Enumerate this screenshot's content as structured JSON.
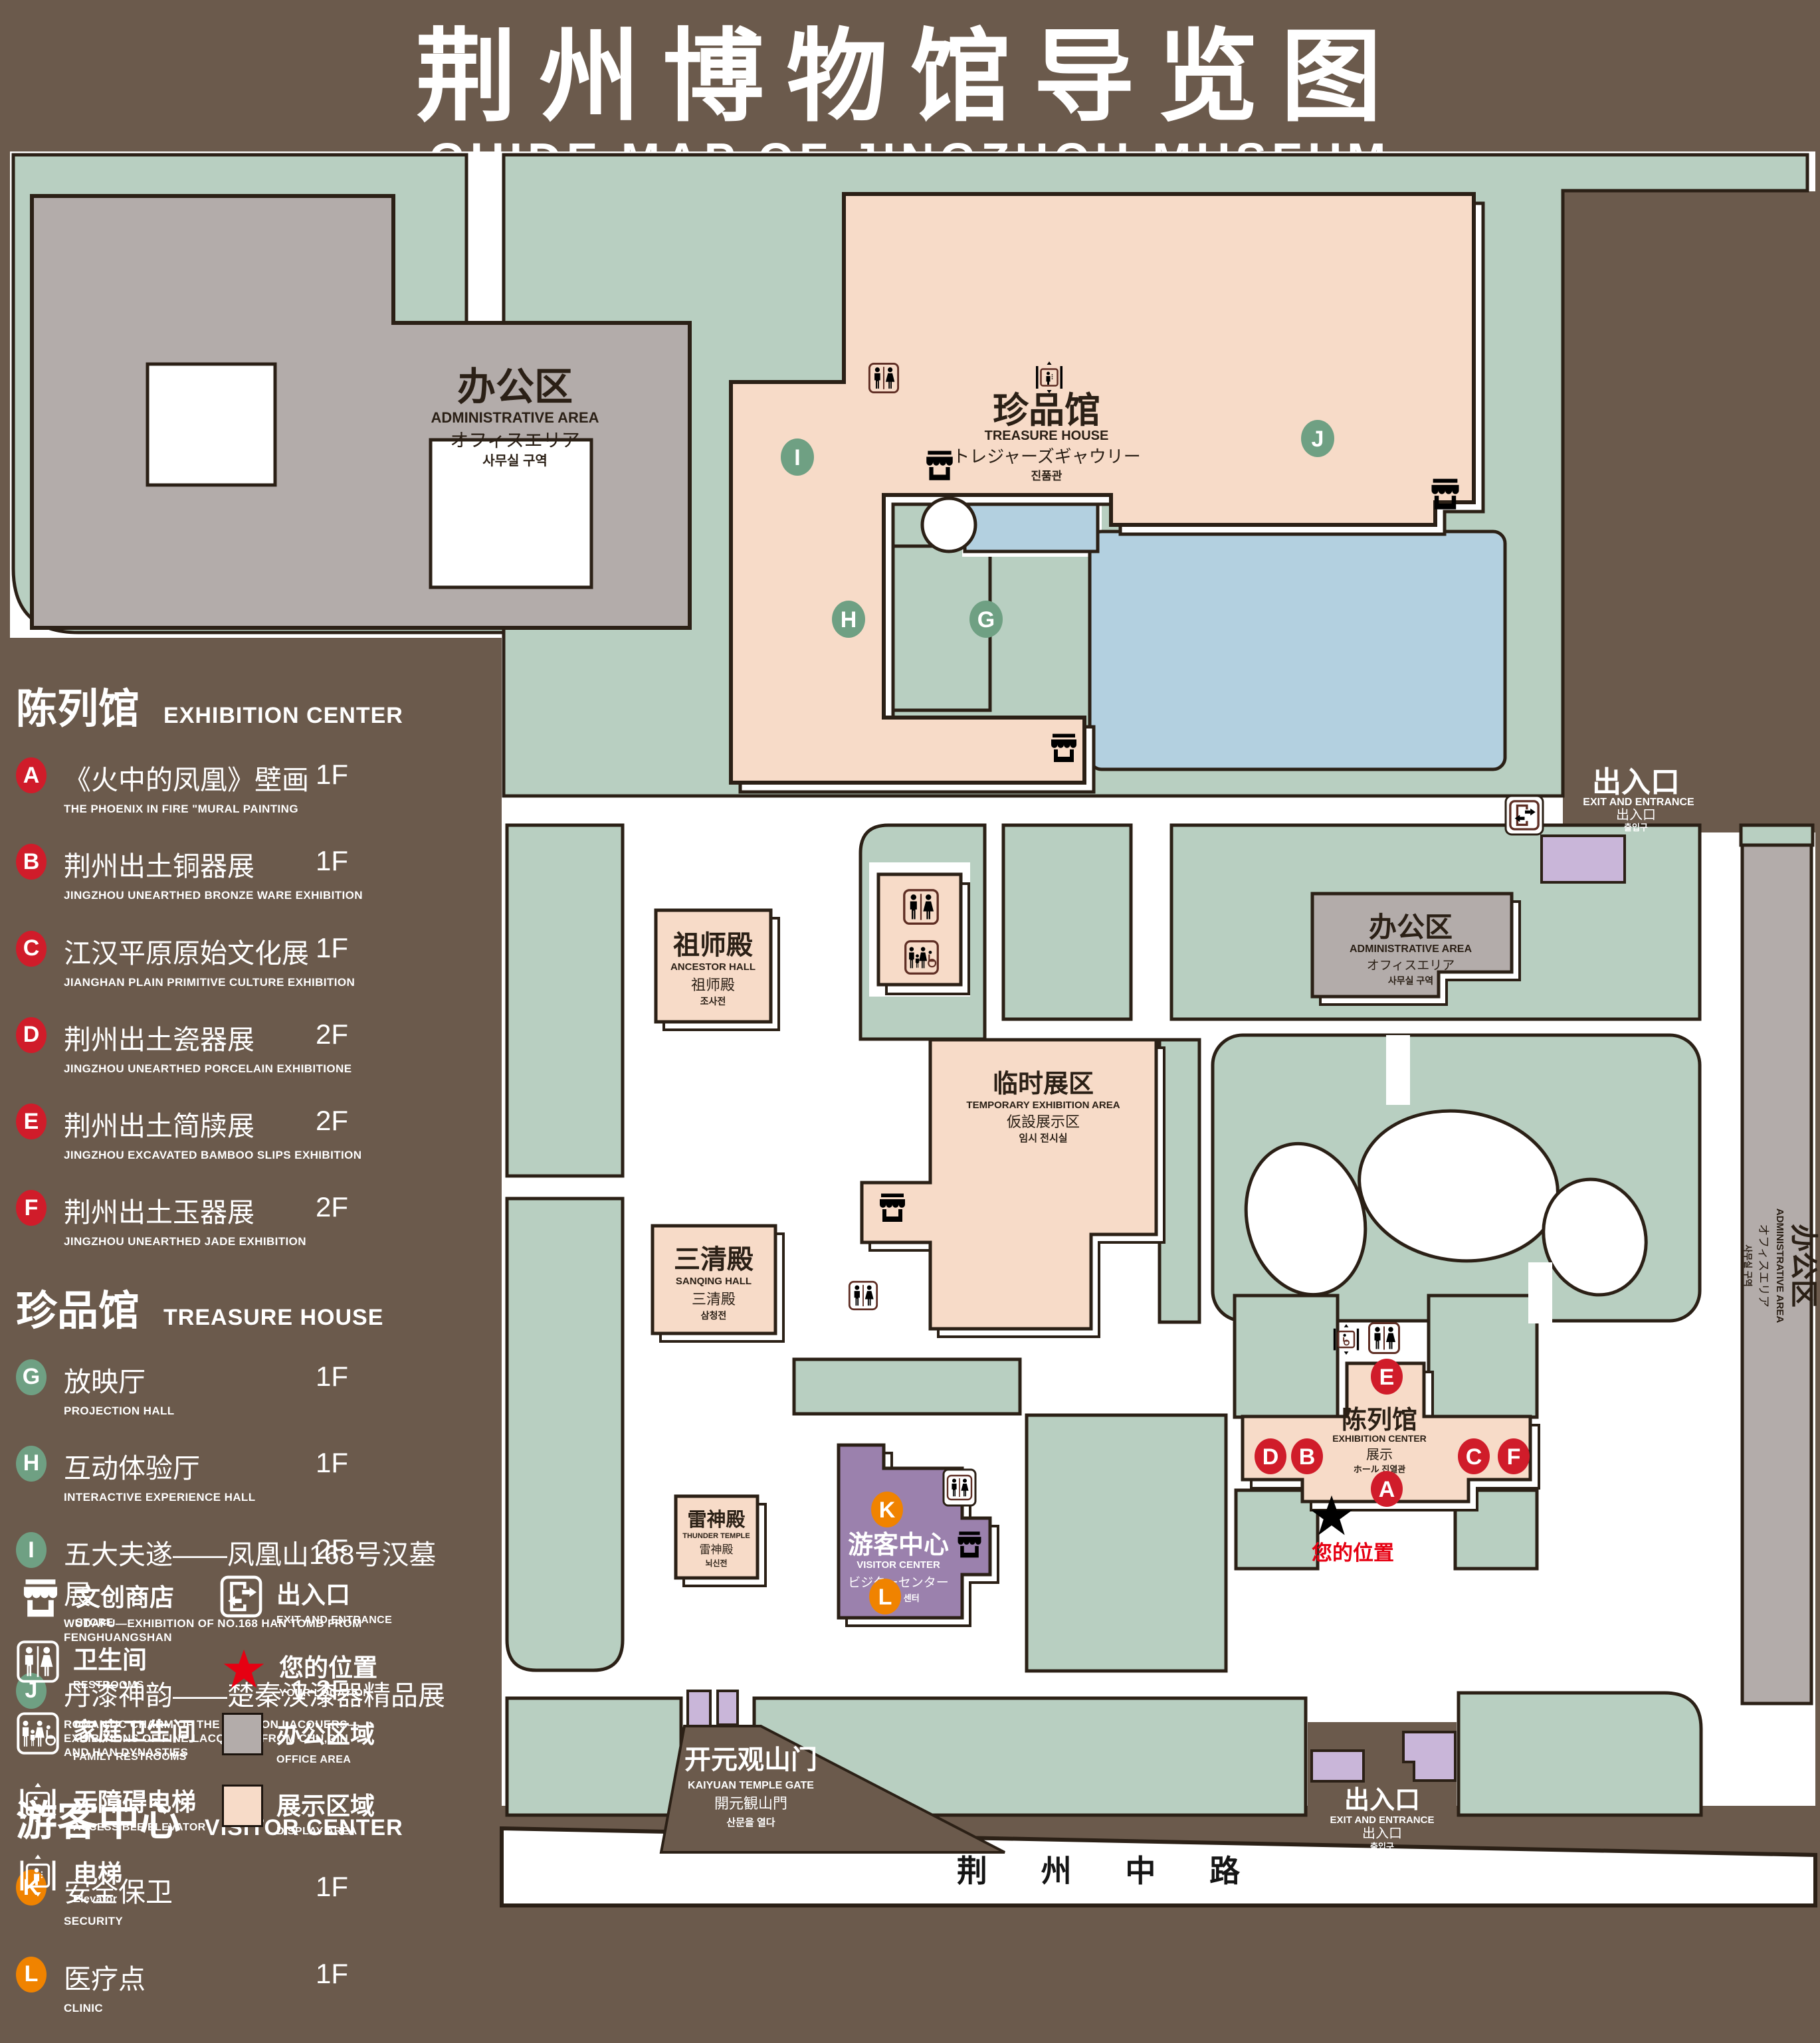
{
  "title": {
    "zh": "荆州博物馆导览图",
    "en": "GUIDE MAP OF JINGZHOU MUSEUM"
  },
  "colors": {
    "background": "#6b5a4c",
    "land": "#b8cfc1",
    "display_area": "#f7dbc8",
    "office_area": "#b3acaa",
    "water": "#b3d0e0",
    "visitor_center": "#9b81ad",
    "gate_building": "#c9b6d9",
    "outline": "#2b2016",
    "map_icon": "#5e2d23",
    "marker_red": "#d01c2a",
    "marker_green": "#6fa083",
    "marker_orange": "#f08300",
    "location_red": "#e60012"
  },
  "legend": {
    "sections": [
      {
        "zh": "陈列馆",
        "en": "EXHIBITION CENTER",
        "items": [
          {
            "letter": "A",
            "zh": "《火中的凤凰》壁画",
            "en": "THE PHOENIX IN FIRE \"MURAL PAINTING",
            "floor": "1F"
          },
          {
            "letter": "B",
            "zh": "荆州出土铜器展",
            "en": "JINGZHOU UNEARTHED BRONZE WARE EXHIBITION",
            "floor": "1F"
          },
          {
            "letter": "C",
            "zh": "江汉平原原始文化展",
            "en": "JIANGHAN PLAIN PRIMITIVE CULTURE EXHIBITION",
            "floor": "1F"
          },
          {
            "letter": "D",
            "zh": "荆州出土瓷器展",
            "en": "JINGZHOU UNEARTHED PORCELAIN EXHIBITIONE",
            "floor": "2F"
          },
          {
            "letter": "E",
            "zh": "荆州出土简牍展",
            "en": "JINGZHOU EXCAVATED BAMBOO SLIPS EXHIBITION",
            "floor": "2F"
          },
          {
            "letter": "F",
            "zh": "荆州出土玉器展",
            "en": "JINGZHOU UNEARTHED JADE EXHIBITION",
            "floor": "2F"
          }
        ]
      },
      {
        "zh": "珍品馆",
        "en": "TREASURE HOUSE",
        "items": [
          {
            "letter": "G",
            "zh": "放映厅",
            "en": "PROJECTION HALL",
            "floor": "1F"
          },
          {
            "letter": "H",
            "zh": "互动体验厅",
            "en": "INTERACTIVE EXPERIENCE HALL",
            "floor": "1F"
          },
          {
            "letter": "I",
            "zh": "五大夫遂——凤凰山168号汉墓展",
            "en": "WUDAFU—EXHIBITION OF NO.168 HAN TOMB FROM FENGHUANGSHAN",
            "floor": "2F"
          },
          {
            "letter": "J",
            "zh": "丹漆神韵——楚秦汉漆器精品展",
            "en": "ROMANTIC CHARM OF THE CRIMSON LACQUERS—EXHIBITIONS OF FINE LACQUERS FROM CHU,QIN AND HAN DYNASTIES",
            "floor": "1-2F"
          }
        ]
      },
      {
        "zh": "游客中心",
        "en": "VISITOR CENTER",
        "items": [
          {
            "letter": "K",
            "zh": "安全保卫",
            "en": "SECURITY",
            "floor": "1F"
          },
          {
            "letter": "L",
            "zh": "医疗点",
            "en": "CLINIC",
            "floor": "1F"
          }
        ]
      }
    ],
    "symbols": [
      {
        "zh": "文创商店",
        "en": "STORE"
      },
      {
        "zh": "卫生间",
        "en": "RESTROOMS"
      },
      {
        "zh": "家庭卫生间",
        "en": "FAMILY RESTROOMS"
      },
      {
        "zh": "无障碍电梯",
        "en": "ACCESSIBLE ELEVATOR"
      },
      {
        "zh": "电梯",
        "en": "Elevator"
      },
      {
        "zh": "出入口",
        "en": "EXIT AND ENTRANCE"
      },
      {
        "zh": "您的位置",
        "en": "YOUR LOCATION"
      },
      {
        "zh": "办公区域",
        "en": "OFFICE AREA"
      },
      {
        "zh": "展示区域",
        "en": "DISPLAY AREA"
      }
    ]
  },
  "map": {
    "admin_area": {
      "zh": "办公区",
      "en": "ADMINISTRATIVE AREA",
      "ja": "オフィスエリア",
      "ko": "사무실 구역"
    },
    "treasure_house": {
      "zh": "珍品馆",
      "en": "TREASURE HOUSE",
      "ja": "トレジャーズギャウリー",
      "ko": "진품관"
    },
    "ancestor_hall": {
      "zh": "祖师殿",
      "en": "ANCESTOR HALL",
      "ja": "祖师殿",
      "ko": "조사전"
    },
    "sanqing_hall": {
      "zh": "三清殿",
      "en": "SANQING HALL",
      "ja": "三清殿",
      "ko": "삼청전"
    },
    "thunder_temple": {
      "zh": "雷神殿",
      "en": "THUNDER TEMPLE",
      "ja": "雷神殿",
      "ko": "뇌신전"
    },
    "temporary_exhibition": {
      "zh": "临时展区",
      "en": "TEMPORARY EXHIBITION AREA",
      "ja": "仮設展示区",
      "ko": "임시 전시실"
    },
    "exhibition_center": {
      "zh": "陈列馆",
      "en": "EXHIBITION CENTER",
      "l3": "展示",
      "l4": "ホール 진열관"
    },
    "visitor_center": {
      "zh": "游客中心",
      "en": "VISITOR CENTER",
      "ja": "ビジターセンター",
      "ko": "관광객 센터"
    },
    "kaiyuan_gate": {
      "zh": "开元观山门",
      "en": "KAIYUAN TEMPLE GATE",
      "ja": "開元観山門",
      "ko": "산문을 열다"
    },
    "exit": {
      "zh": "出入口",
      "en": "EXIT AND ENTRANCE",
      "ja": "出入口",
      "ko": "출입구"
    },
    "road": "荆 州 中 路",
    "your_location": "您的位置",
    "markers": {
      "A": "A",
      "B": "B",
      "C": "C",
      "D": "D",
      "E": "E",
      "F": "F",
      "G": "G",
      "H": "H",
      "I": "I",
      "J": "J",
      "K": "K",
      "L": "L"
    }
  }
}
